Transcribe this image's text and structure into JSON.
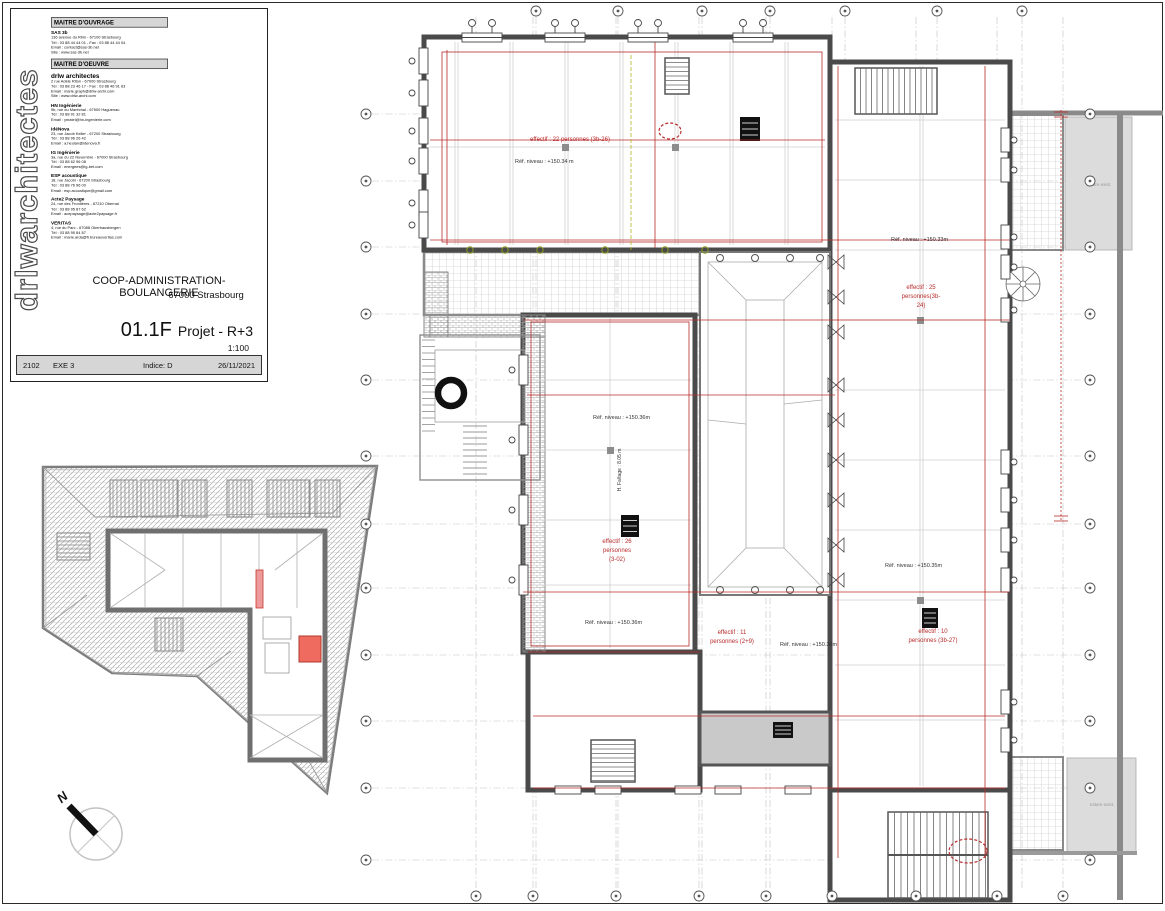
{
  "title_block": {
    "brand_vertical": "drlwarchitectes",
    "maitre_ouvrage": {
      "header": "MAITRE D'OUVRAGE",
      "entries": [
        {
          "name": "SAS 3b",
          "big": false,
          "lines": [
            "136 avenue du Rhin - 67100 Strasbourg",
            "Tél : 03 88 44 44 01 - Fax : 03 88 44 44 04",
            "Email : contact@sas-3b.net",
            "Site : www.sas-3b.net"
          ]
        }
      ]
    },
    "maitre_oeuvre": {
      "header": "MAITRE D'OEUVRE",
      "entries": [
        {
          "name": "drlw architectes",
          "big": true,
          "lines": [
            "2 rue Adèle Riton - 67000 Strasbourg",
            "Tél : 03 88 23 46 17 - Fax : 03 88 46 91 63",
            "Email : marie.graph@drlw-archi.com",
            "Site : www.drlw-archi.com"
          ]
        },
        {
          "name": "HN Ingénierie",
          "big": false,
          "lines": [
            "9b, rue du Maréchal - 67500 Haguenau",
            "Tél : 03 88 91 32 81",
            "Email : ymatel@hn-ingenierie.com"
          ]
        },
        {
          "name": "IdéNova",
          "big": false,
          "lines": [
            "23, rue Jacob Keller - 67200 Strasbourg",
            "Tél : 03 88 96 26 42",
            "Email : a.heulan@idenova.fr"
          ]
        },
        {
          "name": "IG Ingénierie",
          "big": false,
          "lines": [
            "3a, rue du 22 Novembre - 67000 Strasbourg",
            "Tél : 03 88 62 96 08",
            "Email : energees@ig-bet.com"
          ]
        },
        {
          "name": "ESP acoustique",
          "big": false,
          "lines": [
            "18, rue Jacobi - 67200 Strasbourg",
            "Tél : 03 88 76 96 00",
            "Email : esp.acoustique@gmail.com"
          ]
        },
        {
          "name": "Acte2 Paysage",
          "big": false,
          "lines": [
            "24, rue des Frontières - 67210 Obernai",
            "Tél : 03 88 95 87 62",
            "Email : acepaysage@acte2paysage.fr"
          ]
        },
        {
          "name": "VERITAS",
          "big": false,
          "lines": [
            "4, rue du Parc - 67088 Oberhausbergen",
            "Tél : 03 88 95 84 87",
            "Email : marie.arda@fr.bureauveritas.com"
          ]
        }
      ]
    },
    "project": {
      "title": "COOP-ADMINISTRATION-BOULANGERIE",
      "city": "67000 Strasbourg",
      "number": "01.1F",
      "name": "Projet - R+3",
      "scale": "1:100"
    },
    "footer": {
      "job": "2102",
      "phase": "EXE 3",
      "indice": "Indice: D",
      "date": "26/11/2021"
    }
  },
  "north_arrow": {
    "label": "N"
  },
  "plan": {
    "colors": {
      "red": "#b92b2b",
      "blk": "#333333",
      "gray": "#999999",
      "wall": "#4a4a4a",
      "grayfill": "#dcdcdc"
    },
    "annotations": [
      {
        "t": "effectif : 22 personnes (3b-26)",
        "x": 215,
        "y": 141,
        "c": "red",
        "s": 6,
        "a": "m"
      },
      {
        "t": "Réf. niveau : +150.34 m",
        "x": 160,
        "y": 163,
        "c": "blk",
        "s": 5.5,
        "a": "s"
      },
      {
        "t": "Réf. niveau : +150.33m",
        "x": 536,
        "y": 241,
        "c": "blk",
        "s": 5.5,
        "a": "s"
      },
      {
        "t": "effectif : 25",
        "x": 566,
        "y": 289,
        "c": "red",
        "s": 6,
        "a": "m"
      },
      {
        "t": "personnes(3b-",
        "x": 566,
        "y": 298,
        "c": "red",
        "s": 6,
        "a": "m"
      },
      {
        "t": "24)",
        "x": 566,
        "y": 307,
        "c": "red",
        "s": 6,
        "a": "m"
      },
      {
        "t": "Réf. niveau : +150.36m",
        "x": 238,
        "y": 419,
        "c": "blk",
        "s": 5.5,
        "a": "s"
      },
      {
        "t": "H. Faîtage : 8.05 m",
        "x": 266,
        "y": 470,
        "c": "blk",
        "s": 5,
        "a": "m",
        "rot": -90
      },
      {
        "t": "effectif : 26",
        "x": 262,
        "y": 543,
        "c": "red",
        "s": 6,
        "a": "m"
      },
      {
        "t": "personnes",
        "x": 262,
        "y": 552,
        "c": "red",
        "s": 6,
        "a": "m"
      },
      {
        "t": "(3-02)",
        "x": 262,
        "y": 561,
        "c": "red",
        "s": 6,
        "a": "m"
      },
      {
        "t": "Réf. niveau : +150.36m",
        "x": 230,
        "y": 624,
        "c": "blk",
        "s": 5.5,
        "a": "s"
      },
      {
        "t": "effectif : 11",
        "x": 377,
        "y": 634,
        "c": "red",
        "s": 6,
        "a": "m"
      },
      {
        "t": "personnes (2+9)",
        "x": 377,
        "y": 643,
        "c": "red",
        "s": 6,
        "a": "m"
      },
      {
        "t": "Réf. niveau : +150.36m",
        "x": 425,
        "y": 646,
        "c": "blk",
        "s": 5.5,
        "a": "s"
      },
      {
        "t": "Réf. niveau : +150.35m",
        "x": 530,
        "y": 567,
        "c": "blk",
        "s": 5.5,
        "a": "s"
      },
      {
        "t": "effectif : 10",
        "x": 578,
        "y": 633,
        "c": "red",
        "s": 6,
        "a": "m"
      },
      {
        "t": "personnes (3b-27)",
        "x": 578,
        "y": 642,
        "c": "red",
        "s": 6,
        "a": "m"
      },
      {
        "t": "toiture exist.",
        "x": 744,
        "y": 186,
        "c": "gray",
        "s": 4.5,
        "a": "m"
      },
      {
        "t": "toiture exist.",
        "x": 747,
        "y": 806,
        "c": "gray",
        "s": 4.5,
        "a": "m"
      }
    ],
    "grid": {
      "top_x": [
        181,
        263,
        347,
        415,
        490,
        582,
        667
      ],
      "bottom_x": [
        121,
        178,
        261,
        344,
        411,
        477,
        561,
        642,
        708
      ],
      "side_y": [
        114,
        181,
        247,
        314,
        380,
        456,
        524,
        588,
        655,
        721,
        788,
        860
      ],
      "left_x": 11,
      "right_x": 735,
      "top_y": 11,
      "bottom_y": 896
    }
  }
}
